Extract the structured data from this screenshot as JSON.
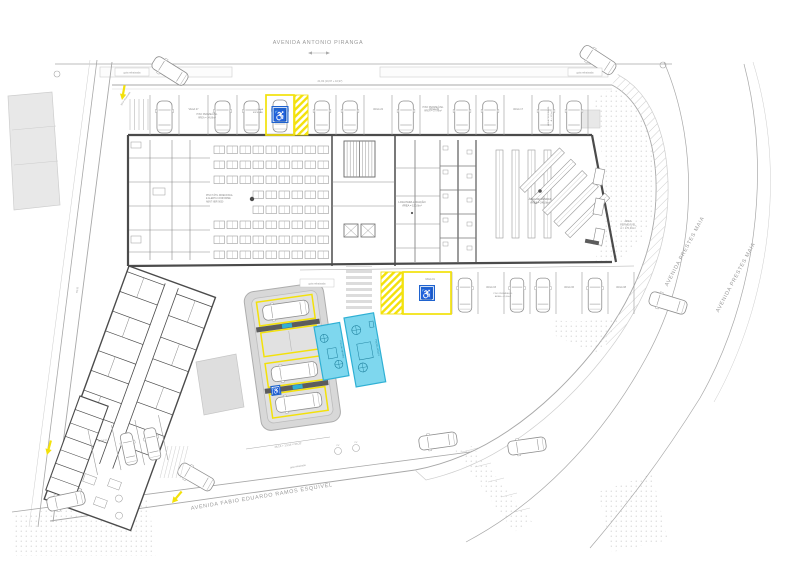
{
  "document": {
    "type": "architectural-site-plan"
  },
  "streets": {
    "top": "AVENIDA ANTONIO PIRANGA",
    "right": "AVENIDA PRESTES MAIA",
    "bottom": "AVENIDA FABIO EDUARDO RAMOS ESQUIVEL"
  },
  "annotations": {
    "curb_cut": "guia rebaixada",
    "permeable_paving_1": [
      "PISO PERMEÁVEL",
      "ÁREA = 34,86m²"
    ],
    "permeable_paving_2": [
      "PISO PERMEÁVEL",
      "ÁREA = 37,46m²"
    ],
    "permeable_paving_3": [
      "PISO PERMEÁVEL",
      "ÁREA = 41,60m²"
    ],
    "permeable_area": [
      "ÁREA",
      "PERMEÁVEL",
      "A = 170,46m²"
    ],
    "permeable_side": [
      "ÁREA PERMEÁVEL",
      "A = 12,5m²"
    ],
    "shop": [
      "LOJA PARA LOCAÇÃO",
      "ÁREA = 150,0m²"
    ],
    "sales": [
      "ÁREA DE VENDAS",
      "ÁREA = 240,0m²"
    ],
    "hall_note": [
      "PISO TÁTIL DIRECIONAL",
      "E ALERTA CONFORME",
      "ABNT NBR 9050"
    ],
    "accessible_stall": [
      "VAGA",
      "ESPECIAL"
    ],
    "dim_top": "21,93 (10,97 + 10,97)",
    "dim_left": "59,32",
    "dim_carport": "46,16 + 13,16 = 59,32",
    "pool_small": "PISCINA INFANTIL",
    "pool_large": "PISCINA ADULTO",
    "manhole": "PV"
  },
  "parking": {
    "row_top_left": [
      "VAGA 28",
      "VAGA 27",
      "VAGA 26",
      "VAGA 25"
    ],
    "row_top_right": [
      "VAGA 24",
      "VAGA 23",
      "VAGA 22",
      "VAGA 21",
      "VAGA 20",
      "VAGA 19",
      "VAGA 18",
      "VAGA 17",
      "VAGA 16",
      "VAGA 15"
    ],
    "row_bottom": [
      "VAGA 02",
      "VAGA 03",
      "VAGA 04",
      "VAGA 05",
      "VAGA 06",
      "VAGA 07",
      "VAGA 08"
    ],
    "row_street": [
      "VAGA 11",
      "VAGA 12",
      "VAGA 13"
    ],
    "accessible_label": "VAGA 01",
    "wheelchair_symbol": "♿"
  },
  "colors": {
    "accent_yellow": "#f3e10a",
    "sign_blue": "#1f63cf",
    "pool_fill": "#7ed7ee",
    "pool_border": "#2fb0d4",
    "pool_text": "#1d7f9c",
    "wall_dark": "#4b4b4b",
    "line_gray": "#a8a8a8",
    "line_light": "#cdcdcd",
    "text_gray": "#8f8f8f",
    "fill_light": "#e8e8e8",
    "carport_fill": "#d8d8d8",
    "bump_dark": "#5c5c5c",
    "stipple": "#c2c2c2"
  }
}
